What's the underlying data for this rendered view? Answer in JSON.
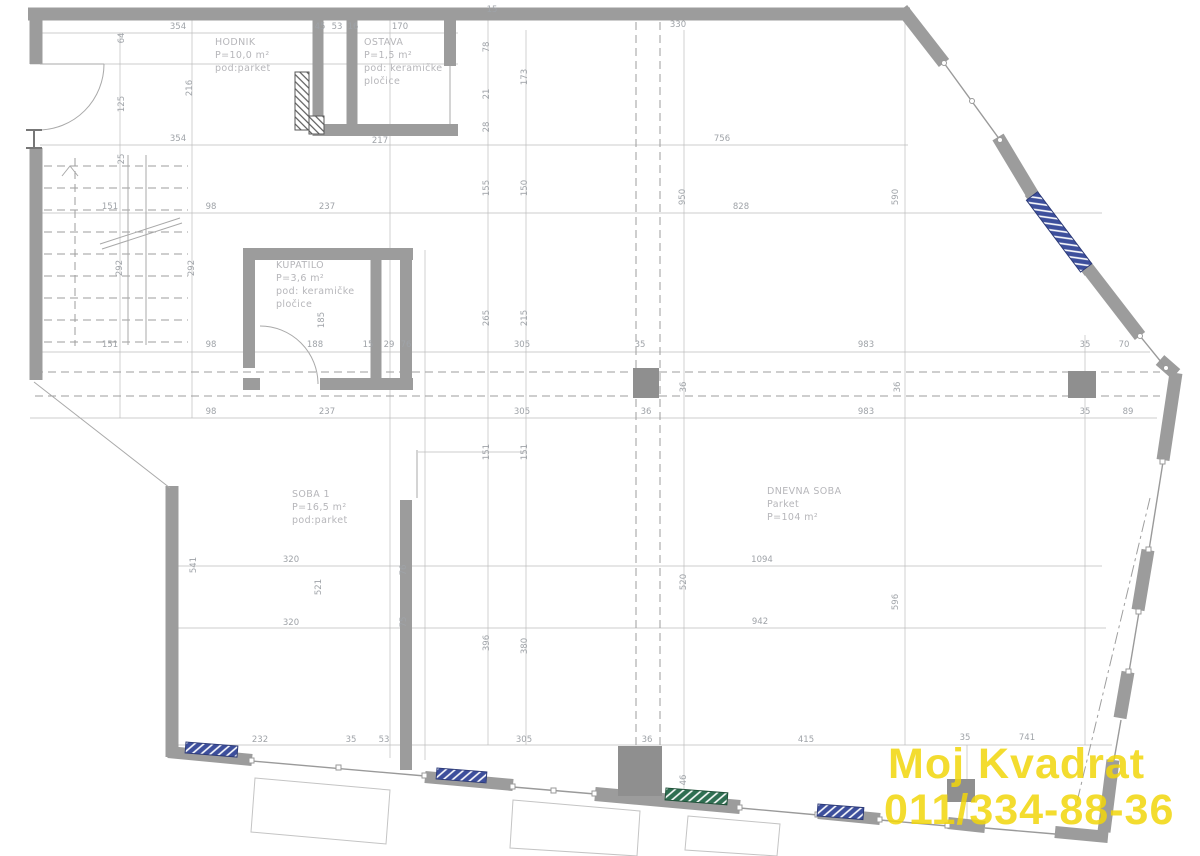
{
  "drawing": {
    "kind_label": "floor-plan",
    "colors": {
      "wall": "#9c9c9c",
      "dimension_text": "#9fa3a8",
      "room_text": "#b6b6ba",
      "radiator_blue": "#3d4f9c",
      "radiator_green": "#2f6f52",
      "watermark_yellow": "#f2d60b"
    }
  },
  "watermark": {
    "line1": "Moj Kvadrat",
    "line2": "011/334-88-36"
  },
  "rooms": [
    {
      "id": "hodnik",
      "lines": [
        "HODNIK",
        "P=10,0 m²",
        "pod:parket"
      ],
      "x": 215,
      "y": 45
    },
    {
      "id": "ostava",
      "lines": [
        "OSTAVA",
        "P=1,5 m²",
        "pod: keramičke",
        "pločice"
      ],
      "x": 364,
      "y": 45
    },
    {
      "id": "kupatilo",
      "lines": [
        "KUPATILO",
        "P=3,6 m²",
        "pod: keramičke",
        "pločice"
      ],
      "x": 276,
      "y": 268
    },
    {
      "id": "soba-1",
      "lines": [
        "SOBA 1",
        "P=16,5 m²",
        "pod:parket"
      ],
      "x": 292,
      "y": 497
    },
    {
      "id": "dnevna-soba",
      "lines": [
        "DNEVNA SOBA",
        "Parket",
        "P=104 m²"
      ],
      "x": 767,
      "y": 494
    }
  ],
  "dimensions": [
    {
      "t": "354",
      "x": 178,
      "y": 29,
      "o": "h"
    },
    {
      "t": "45",
      "x": 320,
      "y": 29,
      "o": "h"
    },
    {
      "t": "53",
      "x": 337,
      "y": 29,
      "o": "h"
    },
    {
      "t": "16",
      "x": 353,
      "y": 29,
      "o": "h"
    },
    {
      "t": "170",
      "x": 400,
      "y": 29,
      "o": "h"
    },
    {
      "t": "15",
      "x": 492,
      "y": 12,
      "o": "h"
    },
    {
      "t": "330",
      "x": 678,
      "y": 27,
      "o": "h"
    },
    {
      "t": "64",
      "x": 124,
      "y": 38,
      "o": "v"
    },
    {
      "t": "125",
      "x": 124,
      "y": 104,
      "o": "v"
    },
    {
      "t": "216",
      "x": 192,
      "y": 88,
      "o": "v"
    },
    {
      "t": "78",
      "x": 489,
      "y": 47,
      "o": "v"
    },
    {
      "t": "21",
      "x": 489,
      "y": 94,
      "o": "v"
    },
    {
      "t": "28",
      "x": 489,
      "y": 127,
      "o": "v"
    },
    {
      "t": "173",
      "x": 527,
      "y": 77,
      "o": "v"
    },
    {
      "t": "354",
      "x": 178,
      "y": 141,
      "o": "h"
    },
    {
      "t": "217",
      "x": 380,
      "y": 143,
      "o": "h"
    },
    {
      "t": "756",
      "x": 722,
      "y": 141,
      "o": "h"
    },
    {
      "t": "25",
      "x": 124,
      "y": 159,
      "o": "v"
    },
    {
      "t": "155",
      "x": 489,
      "y": 188,
      "o": "v"
    },
    {
      "t": "150",
      "x": 527,
      "y": 188,
      "o": "v"
    },
    {
      "t": "950",
      "x": 685,
      "y": 197,
      "o": "v"
    },
    {
      "t": "590",
      "x": 898,
      "y": 197,
      "o": "v"
    },
    {
      "t": "151",
      "x": 110,
      "y": 209,
      "o": "h"
    },
    {
      "t": "98",
      "x": 211,
      "y": 209,
      "o": "h"
    },
    {
      "t": "237",
      "x": 327,
      "y": 209,
      "o": "h"
    },
    {
      "t": "828",
      "x": 741,
      "y": 209,
      "o": "h"
    },
    {
      "t": "292",
      "x": 122,
      "y": 268,
      "o": "v"
    },
    {
      "t": "292",
      "x": 194,
      "y": 268,
      "o": "v"
    },
    {
      "t": "185",
      "x": 324,
      "y": 320,
      "o": "v"
    },
    {
      "t": "265",
      "x": 489,
      "y": 318,
      "o": "v"
    },
    {
      "t": "215",
      "x": 527,
      "y": 318,
      "o": "v"
    },
    {
      "t": "151",
      "x": 110,
      "y": 347,
      "o": "h"
    },
    {
      "t": "98",
      "x": 211,
      "y": 347,
      "o": "h"
    },
    {
      "t": "188",
      "x": 315,
      "y": 347,
      "o": "h"
    },
    {
      "t": "15",
      "x": 368,
      "y": 347,
      "o": "h"
    },
    {
      "t": "29",
      "x": 389,
      "y": 347,
      "o": "h"
    },
    {
      "t": "76",
      "x": 406,
      "y": 347,
      "o": "h"
    },
    {
      "t": "305",
      "x": 522,
      "y": 347,
      "o": "h"
    },
    {
      "t": "35",
      "x": 640,
      "y": 347,
      "o": "h"
    },
    {
      "t": "983",
      "x": 866,
      "y": 347,
      "o": "h"
    },
    {
      "t": "35",
      "x": 1085,
      "y": 347,
      "o": "h"
    },
    {
      "t": "70",
      "x": 1124,
      "y": 347,
      "o": "h"
    },
    {
      "t": "36",
      "x": 686,
      "y": 387,
      "o": "v"
    },
    {
      "t": "36",
      "x": 900,
      "y": 387,
      "o": "v"
    },
    {
      "t": "98",
      "x": 211,
      "y": 414,
      "o": "h"
    },
    {
      "t": "237",
      "x": 327,
      "y": 414,
      "o": "h"
    },
    {
      "t": "305",
      "x": 522,
      "y": 414,
      "o": "h"
    },
    {
      "t": "36",
      "x": 646,
      "y": 414,
      "o": "h"
    },
    {
      "t": "983",
      "x": 866,
      "y": 414,
      "o": "h"
    },
    {
      "t": "35",
      "x": 1085,
      "y": 414,
      "o": "h"
    },
    {
      "t": "89",
      "x": 1128,
      "y": 414,
      "o": "h"
    },
    {
      "t": "151",
      "x": 489,
      "y": 452,
      "o": "v"
    },
    {
      "t": "151",
      "x": 527,
      "y": 452,
      "o": "v"
    },
    {
      "t": "76",
      "x": 406,
      "y": 570,
      "o": "v"
    },
    {
      "t": "75",
      "x": 406,
      "y": 622,
      "o": "v"
    },
    {
      "t": "541",
      "x": 196,
      "y": 565,
      "o": "v"
    },
    {
      "t": "320",
      "x": 291,
      "y": 562,
      "o": "h"
    },
    {
      "t": "521",
      "x": 321,
      "y": 587,
      "o": "v"
    },
    {
      "t": "320",
      "x": 291,
      "y": 625,
      "o": "h"
    },
    {
      "t": "1094",
      "x": 762,
      "y": 562,
      "o": "h"
    },
    {
      "t": "520",
      "x": 686,
      "y": 582,
      "o": "v"
    },
    {
      "t": "596",
      "x": 898,
      "y": 602,
      "o": "v"
    },
    {
      "t": "942",
      "x": 760,
      "y": 624,
      "o": "h"
    },
    {
      "t": "396",
      "x": 489,
      "y": 643,
      "o": "v"
    },
    {
      "t": "380",
      "x": 527,
      "y": 646,
      "o": "v"
    },
    {
      "t": "232",
      "x": 260,
      "y": 742,
      "o": "h"
    },
    {
      "t": "35",
      "x": 351,
      "y": 742,
      "o": "h"
    },
    {
      "t": "53",
      "x": 384,
      "y": 742,
      "o": "h"
    },
    {
      "t": "305",
      "x": 524,
      "y": 742,
      "o": "h"
    },
    {
      "t": "36",
      "x": 647,
      "y": 742,
      "o": "h"
    },
    {
      "t": "415",
      "x": 806,
      "y": 742,
      "o": "h"
    },
    {
      "t": "35",
      "x": 965,
      "y": 740,
      "o": "h"
    },
    {
      "t": "741",
      "x": 1027,
      "y": 740,
      "o": "h"
    },
    {
      "t": "46",
      "x": 686,
      "y": 780,
      "o": "v"
    }
  ]
}
